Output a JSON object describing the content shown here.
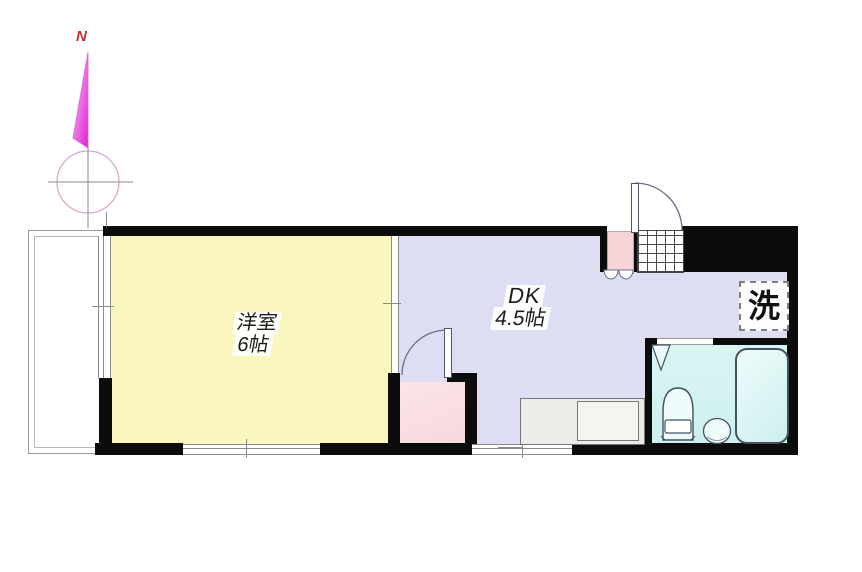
{
  "labels": {
    "compass_north": "N",
    "room_west": {
      "name": "洋室",
      "size": "6帖"
    },
    "dining_kitchen": {
      "name": "DK",
      "size": "4.5帖"
    },
    "laundry": "洗"
  },
  "colors": {
    "room_yellow": "#F9F6BE",
    "room_lavender": "#DEDEF2",
    "room_cyan": "#CDF0EE",
    "closet_pink": "#F8D8DC",
    "entry_pink": "#F6D5D8",
    "wall_black": "#0C0C0C",
    "counter_gray": "#ECECE9",
    "compass_magenta": "#E020D8",
    "compass_red": "#C03030"
  }
}
